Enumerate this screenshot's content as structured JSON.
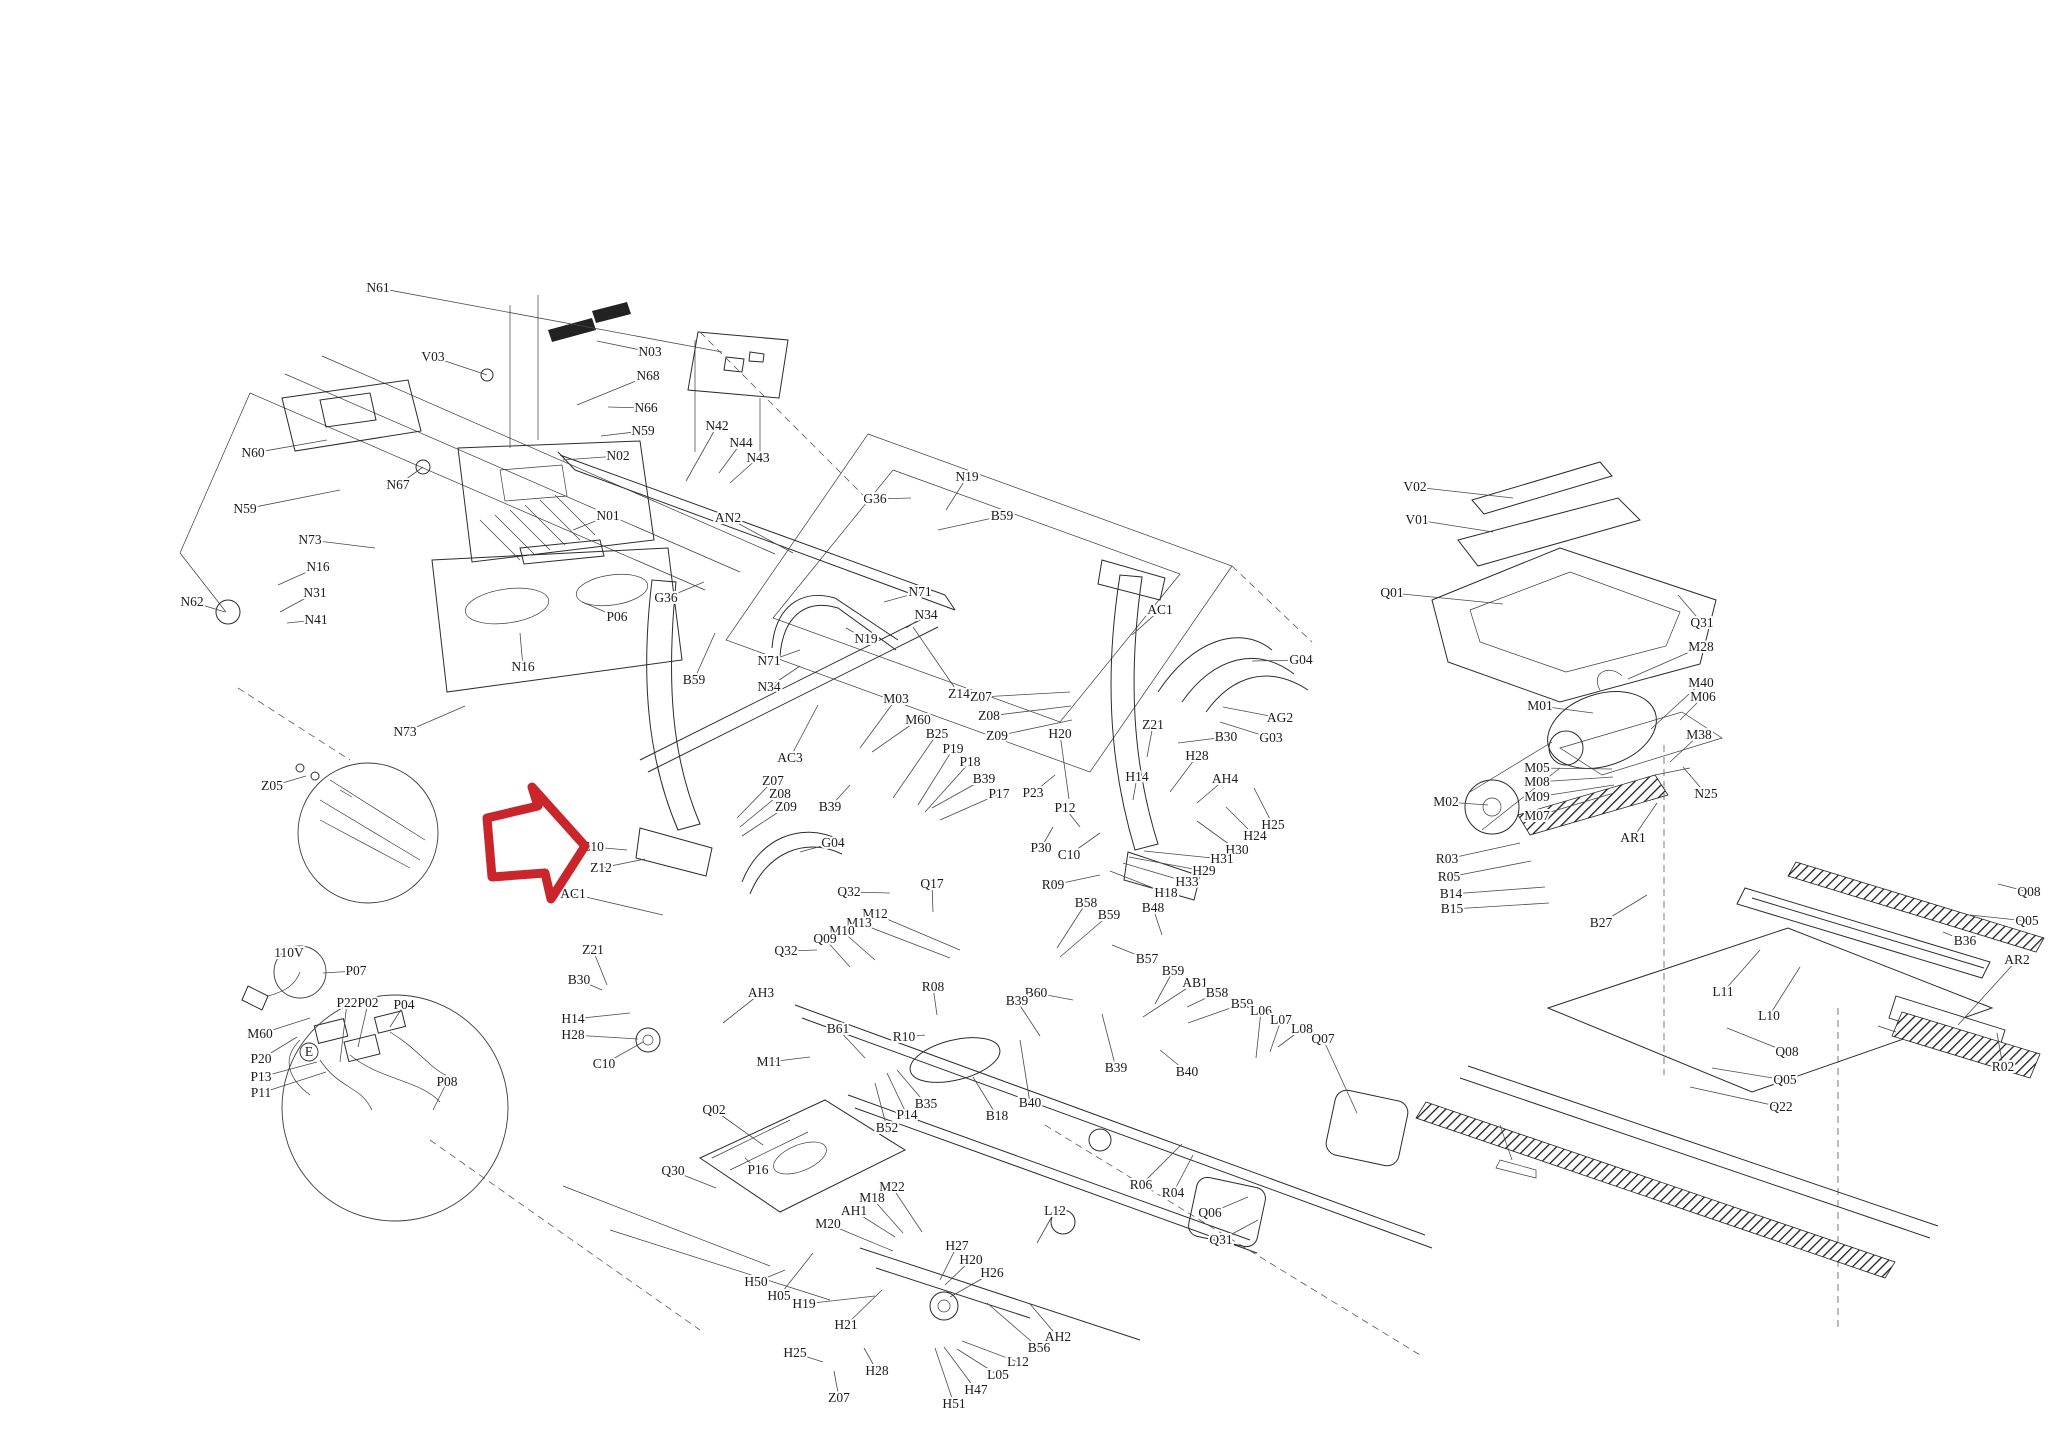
{
  "diagram": {
    "kind": "treadmill-exploded-parts-diagram",
    "background": "#ffffff",
    "line_color": "#2b2b2b",
    "label_color": "#1c1c1c"
  },
  "highlight_arrow": {
    "name": "red-arrow-pointing-at-Z10",
    "color": "#c9252b",
    "stroke_width": 9,
    "points": "487,818 538,806 532,787 585,846 551,899 545,873 492,877"
  },
  "callout_circles": [
    {
      "x": 368,
      "y": 833,
      "r": 70
    },
    {
      "x": 395,
      "y": 1108,
      "r": 113
    },
    {
      "x": 300,
      "y": 972,
      "r": 26
    }
  ],
  "circled_letters": [
    {
      "t": "E",
      "x": 309,
      "y": 1052,
      "r": 9
    }
  ],
  "labels": [
    {
      "t": "N61",
      "x": 378,
      "y": 288,
      "lx": 722,
      "ly": 352
    },
    {
      "t": "V03",
      "x": 433,
      "y": 357,
      "lx": 487,
      "ly": 375
    },
    {
      "t": "N03",
      "x": 650,
      "y": 352,
      "lx": 597,
      "ly": 341
    },
    {
      "t": "N68",
      "x": 648,
      "y": 376,
      "lx": 577,
      "ly": 405
    },
    {
      "t": "N66",
      "x": 646,
      "y": 408,
      "lx": 608,
      "ly": 407
    },
    {
      "t": "N59",
      "x": 643,
      "y": 431,
      "lx": 601,
      "ly": 436
    },
    {
      "t": "N02",
      "x": 618,
      "y": 456,
      "lx": 563,
      "ly": 460
    },
    {
      "t": "N42",
      "x": 717,
      "y": 426,
      "lx": 686,
      "ly": 481
    },
    {
      "t": "N44",
      "x": 741,
      "y": 443,
      "lx": 719,
      "ly": 473
    },
    {
      "t": "N43",
      "x": 758,
      "y": 458,
      "lx": 730,
      "ly": 483
    },
    {
      "t": "N01",
      "x": 608,
      "y": 516,
      "lx": 573,
      "ly": 530
    },
    {
      "t": "AN2",
      "x": 728,
      "y": 518,
      "lx": 793,
      "ly": 553
    },
    {
      "t": "G36",
      "x": 875,
      "y": 499,
      "lx": 911,
      "ly": 498
    },
    {
      "t": "G36",
      "x": 666,
      "y": 598,
      "lx": 704,
      "ly": 582
    },
    {
      "t": "N19",
      "x": 967,
      "y": 477,
      "lx": 946,
      "ly": 510
    },
    {
      "t": "B59",
      "x": 1002,
      "y": 516,
      "lx": 938,
      "ly": 530
    },
    {
      "t": "N71",
      "x": 920,
      "y": 592,
      "lx": 884,
      "ly": 602
    },
    {
      "t": "N34",
      "x": 926,
      "y": 615,
      "lx": 906,
      "ly": 628
    },
    {
      "t": "N19",
      "x": 866,
      "y": 639,
      "lx": 846,
      "ly": 628
    },
    {
      "t": "N71",
      "x": 769,
      "y": 661,
      "lx": 800,
      "ly": 650
    },
    {
      "t": "N34",
      "x": 769,
      "y": 687,
      "lx": 800,
      "ly": 666
    },
    {
      "t": "B59",
      "x": 694,
      "y": 680,
      "lx": 715,
      "ly": 633
    },
    {
      "t": "Z14",
      "x": 959,
      "y": 694,
      "lx": 913,
      "ly": 627
    },
    {
      "t": "Z07",
      "x": 981,
      "y": 697,
      "lx": 1070,
      "ly": 692
    },
    {
      "t": "Z08",
      "x": 989,
      "y": 716,
      "lx": 1071,
      "ly": 706
    },
    {
      "t": "Z09",
      "x": 997,
      "y": 736,
      "lx": 1072,
      "ly": 720
    },
    {
      "t": "M03",
      "x": 896,
      "y": 699,
      "lx": 860,
      "ly": 748
    },
    {
      "t": "M60",
      "x": 918,
      "y": 720,
      "lx": 872,
      "ly": 752
    },
    {
      "t": "B25",
      "x": 937,
      "y": 734,
      "lx": 893,
      "ly": 798
    },
    {
      "t": "P19",
      "x": 953,
      "y": 749,
      "lx": 918,
      "ly": 805
    },
    {
      "t": "P18",
      "x": 970,
      "y": 762,
      "lx": 925,
      "ly": 812
    },
    {
      "t": "B39",
      "x": 984,
      "y": 779,
      "lx": 932,
      "ly": 808
    },
    {
      "t": "P17",
      "x": 999,
      "y": 794,
      "lx": 940,
      "ly": 820
    },
    {
      "t": "B39",
      "x": 830,
      "y": 807,
      "lx": 850,
      "ly": 785
    },
    {
      "t": "Z07",
      "x": 773,
      "y": 781,
      "lx": 737,
      "ly": 818
    },
    {
      "t": "Z08",
      "x": 780,
      "y": 794,
      "lx": 740,
      "ly": 827
    },
    {
      "t": "Z09",
      "x": 786,
      "y": 807,
      "lx": 742,
      "ly": 836
    },
    {
      "t": "G04",
      "x": 833,
      "y": 843,
      "lx": 800,
      "ly": 852
    },
    {
      "t": "AC3",
      "x": 790,
      "y": 758,
      "lx": 818,
      "ly": 705
    },
    {
      "t": "AC1",
      "x": 573,
      "y": 894,
      "lx": 663,
      "ly": 915
    },
    {
      "t": "Z10",
      "x": 593,
      "y": 847,
      "lx": 627,
      "ly": 850
    },
    {
      "t": "Z12",
      "x": 601,
      "y": 868,
      "lx": 645,
      "ly": 859
    },
    {
      "t": "Z05",
      "x": 272,
      "y": 786,
      "lx": 306,
      "ly": 776
    },
    {
      "t": "Z21",
      "x": 593,
      "y": 950,
      "lx": 607,
      "ly": 985
    },
    {
      "t": "B30",
      "x": 579,
      "y": 980,
      "lx": 602,
      "ly": 990
    },
    {
      "t": "H14",
      "x": 573,
      "y": 1019,
      "lx": 630,
      "ly": 1013
    },
    {
      "t": "H28",
      "x": 573,
      "y": 1035,
      "lx": 638,
      "ly": 1039
    },
    {
      "t": "C10",
      "x": 604,
      "y": 1064,
      "lx": 643,
      "ly": 1042
    },
    {
      "t": "AC1",
      "x": 1160,
      "y": 610,
      "lx": 1132,
      "ly": 635
    },
    {
      "t": "G04",
      "x": 1301,
      "y": 660,
      "lx": 1252,
      "ly": 661
    },
    {
      "t": "AG2",
      "x": 1280,
      "y": 718,
      "lx": 1223,
      "ly": 707
    },
    {
      "t": "G03",
      "x": 1271,
      "y": 738,
      "lx": 1220,
      "ly": 722
    },
    {
      "t": "Z21",
      "x": 1153,
      "y": 725,
      "lx": 1147,
      "ly": 757
    },
    {
      "t": "B30",
      "x": 1226,
      "y": 737,
      "lx": 1178,
      "ly": 743
    },
    {
      "t": "H20",
      "x": 1060,
      "y": 734,
      "lx": 1069,
      "ly": 799
    },
    {
      "t": "H28",
      "x": 1197,
      "y": 756,
      "lx": 1170,
      "ly": 792
    },
    {
      "t": "H14",
      "x": 1137,
      "y": 777,
      "lx": 1133,
      "ly": 800
    },
    {
      "t": "AH4",
      "x": 1225,
      "y": 779,
      "lx": 1197,
      "ly": 803
    },
    {
      "t": "H25",
      "x": 1273,
      "y": 825,
      "lx": 1254,
      "ly": 788
    },
    {
      "t": "H24",
      "x": 1255,
      "y": 836,
      "lx": 1226,
      "ly": 807
    },
    {
      "t": "H30",
      "x": 1237,
      "y": 850,
      "lx": 1197,
      "ly": 821
    },
    {
      "t": "H31",
      "x": 1222,
      "y": 859,
      "lx": 1144,
      "ly": 851
    },
    {
      "t": "H29",
      "x": 1204,
      "y": 871,
      "lx": 1129,
      "ly": 857
    },
    {
      "t": "H33",
      "x": 1187,
      "y": 882,
      "lx": 1123,
      "ly": 863
    },
    {
      "t": "H18",
      "x": 1166,
      "y": 893,
      "lx": 1110,
      "ly": 871
    },
    {
      "t": "P23",
      "x": 1033,
      "y": 793,
      "lx": 1055,
      "ly": 775
    },
    {
      "t": "P12",
      "x": 1065,
      "y": 808,
      "lx": 1080,
      "ly": 827
    },
    {
      "t": "P30",
      "x": 1041,
      "y": 848,
      "lx": 1053,
      "ly": 827
    },
    {
      "t": "C10",
      "x": 1069,
      "y": 855,
      "lx": 1100,
      "ly": 833
    },
    {
      "t": "R09",
      "x": 1053,
      "y": 885,
      "lx": 1100,
      "ly": 875
    },
    {
      "t": "Q32",
      "x": 849,
      "y": 892,
      "lx": 890,
      "ly": 893
    },
    {
      "t": "Q17",
      "x": 932,
      "y": 884,
      "lx": 933,
      "ly": 912
    },
    {
      "t": "B58",
      "x": 1086,
      "y": 903,
      "lx": 1057,
      "ly": 948
    },
    {
      "t": "B59",
      "x": 1109,
      "y": 915,
      "lx": 1060,
      "ly": 957
    },
    {
      "t": "B48",
      "x": 1153,
      "y": 908,
      "lx": 1162,
      "ly": 935
    },
    {
      "t": "M12",
      "x": 875,
      "y": 914,
      "lx": 960,
      "ly": 950
    },
    {
      "t": "M13",
      "x": 859,
      "y": 923,
      "lx": 950,
      "ly": 958
    },
    {
      "t": "M10",
      "x": 842,
      "y": 931,
      "lx": 875,
      "ly": 960
    },
    {
      "t": "Q09",
      "x": 825,
      "y": 939,
      "lx": 850,
      "ly": 967
    },
    {
      "t": "Q32",
      "x": 786,
      "y": 951,
      "lx": 817,
      "ly": 950
    },
    {
      "t": "R08",
      "x": 933,
      "y": 987,
      "lx": 937,
      "ly": 1015
    },
    {
      "t": "B60",
      "x": 1036,
      "y": 993,
      "lx": 1073,
      "ly": 1000
    },
    {
      "t": "B39",
      "x": 1017,
      "y": 1001,
      "lx": 1040,
      "ly": 1036
    },
    {
      "t": "B61",
      "x": 838,
      "y": 1029,
      "lx": 865,
      "ly": 1058
    },
    {
      "t": "R10",
      "x": 904,
      "y": 1037,
      "lx": 925,
      "ly": 1035
    },
    {
      "t": "M11",
      "x": 769,
      "y": 1062,
      "lx": 810,
      "ly": 1057
    },
    {
      "t": "AH3",
      "x": 761,
      "y": 993,
      "lx": 723,
      "ly": 1023
    },
    {
      "t": "B57",
      "x": 1147,
      "y": 959,
      "lx": 1112,
      "ly": 945
    },
    {
      "t": "B59",
      "x": 1173,
      "y": 971,
      "lx": 1155,
      "ly": 1004
    },
    {
      "t": "AB1",
      "x": 1195,
      "y": 983,
      "lx": 1143,
      "ly": 1017
    },
    {
      "t": "B58",
      "x": 1217,
      "y": 993,
      "lx": 1187,
      "ly": 1007
    },
    {
      "t": "B59",
      "x": 1242,
      "y": 1004,
      "lx": 1188,
      "ly": 1023
    },
    {
      "t": "L06",
      "x": 1261,
      "y": 1011,
      "lx": 1256,
      "ly": 1058
    },
    {
      "t": "L07",
      "x": 1281,
      "y": 1020,
      "lx": 1270,
      "ly": 1052
    },
    {
      "t": "L08",
      "x": 1302,
      "y": 1029,
      "lx": 1278,
      "ly": 1047
    },
    {
      "t": "Q07",
      "x": 1323,
      "y": 1039,
      "lx": 1357,
      "ly": 1113
    },
    {
      "t": "B40",
      "x": 1187,
      "y": 1072,
      "lx": 1160,
      "ly": 1050
    },
    {
      "t": "B39",
      "x": 1116,
      "y": 1068,
      "lx": 1102,
      "ly": 1014
    },
    {
      "t": "B18",
      "x": 997,
      "y": 1116,
      "lx": 973,
      "ly": 1077
    },
    {
      "t": "B40",
      "x": 1030,
      "y": 1103,
      "lx": 1020,
      "ly": 1040
    },
    {
      "t": "B35",
      "x": 926,
      "y": 1104,
      "lx": 897,
      "ly": 1070
    },
    {
      "t": "P14",
      "x": 907,
      "y": 1115,
      "lx": 887,
      "ly": 1073
    },
    {
      "t": "B52",
      "x": 887,
      "y": 1128,
      "lx": 875,
      "ly": 1083
    },
    {
      "t": "Q02",
      "x": 714,
      "y": 1110,
      "lx": 763,
      "ly": 1145
    },
    {
      "t": "Q30",
      "x": 673,
      "y": 1171,
      "lx": 716,
      "ly": 1188
    },
    {
      "t": "P16",
      "x": 758,
      "y": 1170,
      "lx": 745,
      "ly": 1158
    },
    {
      "t": "M22",
      "x": 892,
      "y": 1187,
      "lx": 922,
      "ly": 1232
    },
    {
      "t": "M18",
      "x": 872,
      "y": 1198,
      "lx": 903,
      "ly": 1233
    },
    {
      "t": "AH1",
      "x": 854,
      "y": 1211,
      "lx": 895,
      "ly": 1237
    },
    {
      "t": "M20",
      "x": 828,
      "y": 1224,
      "lx": 893,
      "ly": 1251
    },
    {
      "t": "H27",
      "x": 957,
      "y": 1246,
      "lx": 940,
      "ly": 1280
    },
    {
      "t": "H20",
      "x": 971,
      "y": 1260,
      "lx": 945,
      "ly": 1285
    },
    {
      "t": "H26",
      "x": 992,
      "y": 1273,
      "lx": 950,
      "ly": 1297
    },
    {
      "t": "L12",
      "x": 1055,
      "y": 1211,
      "lx": 1037,
      "ly": 1243
    },
    {
      "t": "H50",
      "x": 756,
      "y": 1282,
      "lx": 785,
      "ly": 1270
    },
    {
      "t": "H05",
      "x": 779,
      "y": 1296,
      "lx": 813,
      "ly": 1253
    },
    {
      "t": "H19",
      "x": 804,
      "y": 1304,
      "lx": 875,
      "ly": 1296
    },
    {
      "t": "H21",
      "x": 846,
      "y": 1325,
      "lx": 882,
      "ly": 1290
    },
    {
      "t": "H25",
      "x": 795,
      "y": 1353,
      "lx": 823,
      "ly": 1362
    },
    {
      "t": "H28",
      "x": 877,
      "y": 1371,
      "lx": 864,
      "ly": 1348
    },
    {
      "t": "Z07",
      "x": 839,
      "y": 1398,
      "lx": 834,
      "ly": 1371
    },
    {
      "t": "AH2",
      "x": 1058,
      "y": 1337,
      "lx": 1030,
      "ly": 1304
    },
    {
      "t": "B56",
      "x": 1039,
      "y": 1348,
      "lx": 987,
      "ly": 1303
    },
    {
      "t": "L12",
      "x": 1018,
      "y": 1362,
      "lx": 962,
      "ly": 1341
    },
    {
      "t": "L05",
      "x": 998,
      "y": 1375,
      "lx": 957,
      "ly": 1349
    },
    {
      "t": "H47",
      "x": 976,
      "y": 1390,
      "lx": 944,
      "ly": 1347
    },
    {
      "t": "H51",
      "x": 954,
      "y": 1404,
      "lx": 935,
      "ly": 1348
    },
    {
      "t": "R06",
      "x": 1141,
      "y": 1185,
      "lx": 1182,
      "ly": 1144
    },
    {
      "t": "R04",
      "x": 1173,
      "y": 1193,
      "lx": 1193,
      "ly": 1155
    },
    {
      "t": "Q06",
      "x": 1210,
      "y": 1213,
      "lx": 1248,
      "ly": 1197
    },
    {
      "t": "Q31",
      "x": 1221,
      "y": 1240,
      "lx": 1258,
      "ly": 1220
    },
    {
      "t": "V02",
      "x": 1415,
      "y": 487,
      "lx": 1513,
      "ly": 498
    },
    {
      "t": "V01",
      "x": 1417,
      "y": 520,
      "lx": 1493,
      "ly": 532
    },
    {
      "t": "Q01",
      "x": 1392,
      "y": 593,
      "lx": 1503,
      "ly": 604
    },
    {
      "t": "Q31",
      "x": 1702,
      "y": 623,
      "lx": 1678,
      "ly": 595
    },
    {
      "t": "M28",
      "x": 1701,
      "y": 647,
      "lx": 1628,
      "ly": 679
    },
    {
      "t": "M40",
      "x": 1701,
      "y": 683,
      "lx": 1651,
      "ly": 729
    },
    {
      "t": "M06",
      "x": 1703,
      "y": 697,
      "lx": 1680,
      "ly": 720
    },
    {
      "t": "M38",
      "x": 1699,
      "y": 735,
      "lx": 1670,
      "ly": 762
    },
    {
      "t": "M01",
      "x": 1540,
      "y": 706,
      "lx": 1593,
      "ly": 713
    },
    {
      "t": "M05",
      "x": 1537,
      "y": 768,
      "lx": 1612,
      "ly": 769
    },
    {
      "t": "M08",
      "x": 1537,
      "y": 782,
      "lx": 1613,
      "ly": 777
    },
    {
      "t": "M09",
      "x": 1537,
      "y": 797,
      "lx": 1614,
      "ly": 785
    },
    {
      "t": "M07",
      "x": 1537,
      "y": 816,
      "lx": 1614,
      "ly": 793
    },
    {
      "t": "M02",
      "x": 1446,
      "y": 802,
      "lx": 1488,
      "ly": 805
    },
    {
      "t": "N25",
      "x": 1706,
      "y": 794,
      "lx": 1683,
      "ly": 767
    },
    {
      "t": "AR1",
      "x": 1633,
      "y": 838,
      "lx": 1657,
      "ly": 803
    },
    {
      "t": "R03",
      "x": 1447,
      "y": 859,
      "lx": 1520,
      "ly": 843
    },
    {
      "t": "R05",
      "x": 1449,
      "y": 877,
      "lx": 1531,
      "ly": 861
    },
    {
      "t": "B14",
      "x": 1451,
      "y": 894,
      "lx": 1545,
      "ly": 887
    },
    {
      "t": "B15",
      "x": 1452,
      "y": 909,
      "lx": 1549,
      "ly": 903
    },
    {
      "t": "B27",
      "x": 1601,
      "y": 923,
      "lx": 1647,
      "ly": 895
    },
    {
      "t": "L11",
      "x": 1723,
      "y": 992,
      "lx": 1760,
      "ly": 950
    },
    {
      "t": "L10",
      "x": 1769,
      "y": 1016,
      "lx": 1800,
      "ly": 967
    },
    {
      "t": "Q08",
      "x": 1787,
      "y": 1052,
      "lx": 1727,
      "ly": 1028
    },
    {
      "t": "Q05",
      "x": 1785,
      "y": 1080,
      "lx": 1712,
      "ly": 1068
    },
    {
      "t": "Q22",
      "x": 1781,
      "y": 1107,
      "lx": 1690,
      "ly": 1087
    },
    {
      "t": "Q08",
      "x": 2029,
      "y": 892,
      "lx": 1998,
      "ly": 884
    },
    {
      "t": "Q05",
      "x": 2027,
      "y": 921,
      "lx": 1970,
      "ly": 915
    },
    {
      "t": "B36",
      "x": 1965,
      "y": 941,
      "lx": 1943,
      "ly": 932
    },
    {
      "t": "AR2",
      "x": 2017,
      "y": 960,
      "lx": 1958,
      "ly": 1025
    },
    {
      "t": "R02",
      "x": 2003,
      "y": 1067,
      "lx": 1997,
      "ly": 1033
    },
    {
      "t": "110V",
      "x": 289,
      "y": 953
    },
    {
      "t": "P07",
      "x": 356,
      "y": 971,
      "lx": 323,
      "ly": 973
    },
    {
      "t": "P22",
      "x": 347,
      "y": 1003,
      "lx": 340,
      "ly": 1062
    },
    {
      "t": "P02",
      "x": 368,
      "y": 1003,
      "lx": 358,
      "ly": 1047
    },
    {
      "t": "P04",
      "x": 404,
      "y": 1005,
      "lx": 390,
      "ly": 1027
    },
    {
      "t": "M60",
      "x": 260,
      "y": 1034,
      "lx": 310,
      "ly": 1018
    },
    {
      "t": "P20",
      "x": 261,
      "y": 1059,
      "lx": 297,
      "ly": 1037
    },
    {
      "t": "P13",
      "x": 261,
      "y": 1077,
      "lx": 317,
      "ly": 1062
    },
    {
      "t": "P11",
      "x": 261,
      "y": 1093,
      "lx": 326,
      "ly": 1072
    },
    {
      "t": "P08",
      "x": 447,
      "y": 1082,
      "lx": 433,
      "ly": 1110
    },
    {
      "t": "N73",
      "x": 310,
      "y": 540,
      "lx": 375,
      "ly": 548
    },
    {
      "t": "N73",
      "x": 405,
      "y": 732,
      "lx": 465,
      "ly": 706
    },
    {
      "t": "N16",
      "x": 318,
      "y": 567,
      "lx": 278,
      "ly": 585
    },
    {
      "t": "N31",
      "x": 315,
      "y": 593,
      "lx": 280,
      "ly": 612
    },
    {
      "t": "N41",
      "x": 316,
      "y": 620,
      "lx": 287,
      "ly": 623
    },
    {
      "t": "N62",
      "x": 192,
      "y": 602,
      "lx": 225,
      "ly": 612
    },
    {
      "t": "N60",
      "x": 253,
      "y": 453,
      "lx": 327,
      "ly": 440
    },
    {
      "t": "N59",
      "x": 245,
      "y": 509,
      "lx": 340,
      "ly": 490
    },
    {
      "t": "N67",
      "x": 398,
      "y": 485,
      "lx": 423,
      "ly": 467
    },
    {
      "t": "P06",
      "x": 617,
      "y": 617,
      "lx": 582,
      "ly": 602
    },
    {
      "t": "N16",
      "x": 523,
      "y": 667,
      "lx": 520,
      "ly": 633
    }
  ]
}
